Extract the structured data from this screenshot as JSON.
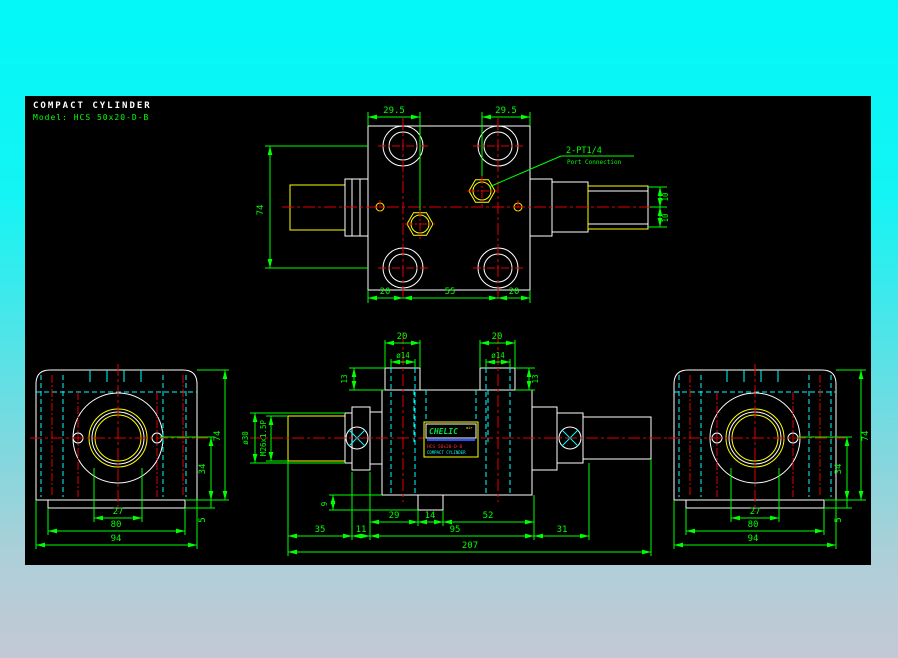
{
  "header": {
    "product": "COMPACT CYLINDER",
    "model_line": "Model: HCS 50x20-D-B"
  },
  "port_annotation": {
    "line1": "2-PT1/4",
    "line2": "Port Connection"
  },
  "nameplate": {
    "brand": "CHELIC",
    "brand_mark": "air",
    "model": "HCS 50x20-D-B",
    "product": "COMPACT CYLINDER"
  },
  "top_view": {
    "dim_port_left": "29.5",
    "dim_port_right": "29.5",
    "dim_height": "74",
    "dim_bottom_left": "20",
    "dim_bottom_center": "55",
    "dim_bottom_right": "20",
    "dim_rod_upper": "10",
    "dim_rod_lower": "10"
  },
  "front_view": {
    "dim_boss_left": "20",
    "dim_boss_right": "20",
    "dim_hole_left": "ø14",
    "dim_hole_right": "ø14",
    "dim_boss_height_left": "13",
    "dim_boss_height_right": "13",
    "dim_rod_dia": "ø30",
    "dim_rod_thread": "M26x1.5P",
    "dim_foot": "9",
    "dim_29": "29",
    "dim_14": "14",
    "dim_52": "52",
    "dim_35": "35",
    "dim_11": "11",
    "dim_95": "95",
    "dim_31": "31",
    "dim_total": "207"
  },
  "side_view": {
    "dim_27": "27",
    "dim_80": "80",
    "dim_94": "94",
    "dim_74": "74",
    "dim_34": "34",
    "dim_5": "5"
  },
  "colors": {
    "canvas": "#000000",
    "background_top": "#00f7f7",
    "background_bottom": "#c3c8d5",
    "outline": "#ffffff",
    "dimension": "#00ff00",
    "centerline": "#e60000",
    "hidden": "#00ffff",
    "thread": "#ffff00",
    "brand_green": "#00e040",
    "brand_bar": "#2b4fff",
    "brand_model": "#ff3030",
    "brand_product": "#00ffff"
  }
}
